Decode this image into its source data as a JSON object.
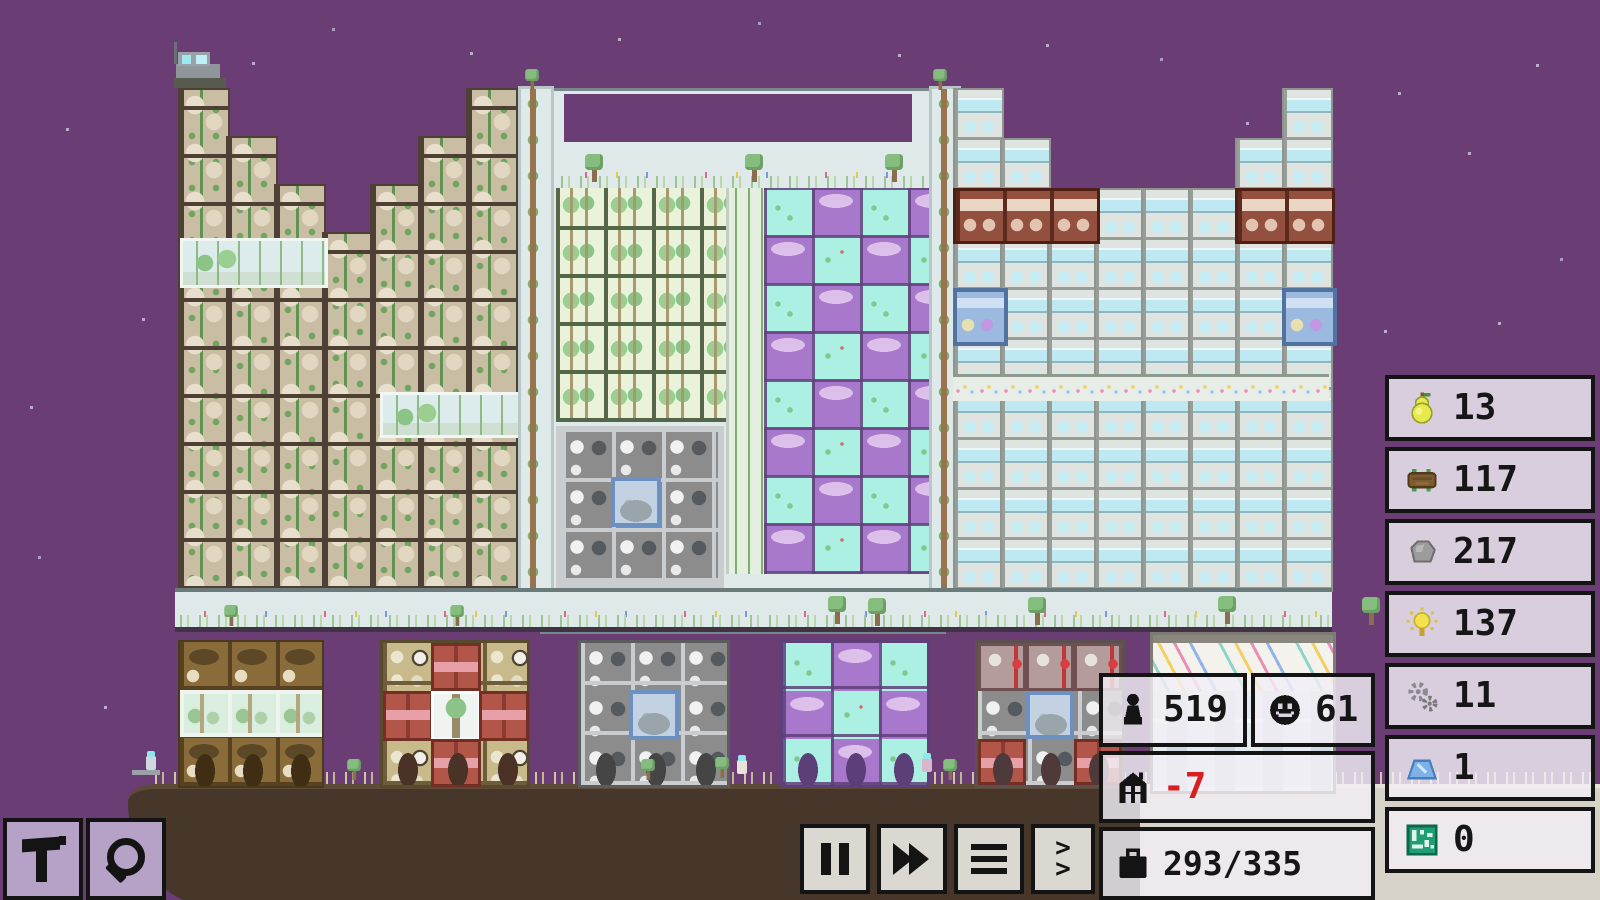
{
  "game": {
    "scene": {
      "description": "pixel-art vertical city at night on a floating brown landmass",
      "sky_color": "#6a3d75",
      "ground_color": "#46372a",
      "plateau_color": "#d6d2c8"
    },
    "hud": {
      "resources": [
        {
          "name": "food",
          "icon": "pear-icon",
          "value": "13"
        },
        {
          "name": "wood",
          "icon": "log-icon",
          "value": "117"
        },
        {
          "name": "stone",
          "icon": "stone-icon",
          "value": "217"
        },
        {
          "name": "energy",
          "icon": "bulb-icon",
          "value": "137"
        },
        {
          "name": "machine-parts",
          "icon": "gears-icon",
          "value": "11"
        },
        {
          "name": "crystal",
          "icon": "crystal-icon",
          "value": "1"
        },
        {
          "name": "computer-chips",
          "icon": "chip-icon",
          "value": "0"
        }
      ],
      "stats": {
        "population": {
          "icon": "person-icon",
          "value": "519"
        },
        "happiness": {
          "icon": "smiley-icon",
          "value": "61"
        },
        "housing": {
          "icon": "house-icon",
          "value": "-7",
          "value_color": "#d81f1f"
        },
        "jobs": {
          "icon": "briefcase-icon",
          "value": "293/335"
        }
      },
      "time_controls": [
        {
          "action": "pause",
          "icon": "pause-icon"
        },
        {
          "action": "fast-forward",
          "icon": "fast-forward-icon"
        },
        {
          "action": "menu",
          "icon": "menu-icon"
        },
        {
          "action": "expand",
          "icon": "chevrons-icon"
        }
      ],
      "tools": [
        {
          "action": "build",
          "icon": "hammer-icon"
        },
        {
          "action": "inspect",
          "icon": "magnifier-icon"
        }
      ]
    }
  }
}
